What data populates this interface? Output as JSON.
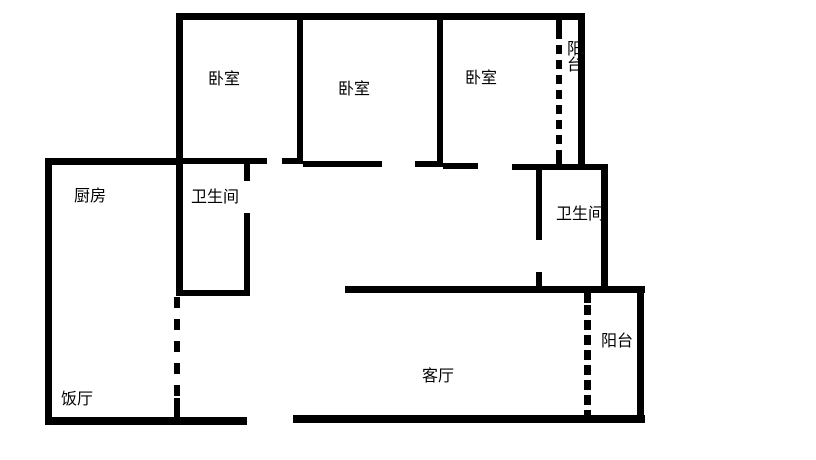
{
  "title": "apartment-floor-plan",
  "colors": {
    "wall": "#000000",
    "background": "#ffffff",
    "text": "#000000"
  },
  "rooms": [
    {
      "id": "bedroom-1",
      "label": "卧室",
      "x": 208,
      "y": 72,
      "vertical": false
    },
    {
      "id": "bedroom-2",
      "label": "卧室",
      "x": 338,
      "y": 82,
      "vertical": false
    },
    {
      "id": "bedroom-3",
      "label": "卧室",
      "x": 465,
      "y": 71,
      "vertical": false
    },
    {
      "id": "balcony-top",
      "label": "阳台",
      "x": 563,
      "y": 40,
      "vertical": true
    },
    {
      "id": "kitchen",
      "label": "厨房",
      "x": 74,
      "y": 189,
      "vertical": false
    },
    {
      "id": "bathroom-left",
      "label": "卫生间",
      "x": 191,
      "y": 190,
      "vertical": false
    },
    {
      "id": "bathroom-right",
      "label": "卫生间",
      "x": 556,
      "y": 207,
      "vertical": false
    },
    {
      "id": "living-room",
      "label": "客厅",
      "x": 422,
      "y": 369,
      "vertical": false
    },
    {
      "id": "balcony-right",
      "label": "阳台",
      "x": 601,
      "y": 334,
      "vertical": false
    },
    {
      "id": "dining-room",
      "label": "饭厅",
      "x": 61,
      "y": 392,
      "vertical": false
    }
  ],
  "walls": {
    "solid": [
      {
        "name": "top-outer-wall",
        "x": 177,
        "y": 13,
        "w": 408,
        "h": 7
      },
      {
        "name": "bedroom1-left-wall",
        "x": 176,
        "y": 13,
        "w": 7,
        "h": 283
      },
      {
        "name": "divider-bedroom1-bedroom2",
        "x": 297,
        "y": 13,
        "w": 6,
        "h": 151
      },
      {
        "name": "divider-bedroom2-bedroom3",
        "x": 437,
        "y": 13,
        "w": 6,
        "h": 153
      },
      {
        "name": "bedroom3-right-wall",
        "x": 578,
        "y": 13,
        "w": 7,
        "h": 154
      },
      {
        "name": "balcony-top-stub-upper",
        "x": 556,
        "y": 20,
        "w": 6,
        "h": 10
      },
      {
        "name": "balcony-top-stub-lower",
        "x": 556,
        "y": 152,
        "w": 6,
        "h": 15
      },
      {
        "name": "kitchen-top-wall",
        "x": 45,
        "y": 158,
        "w": 138,
        "h": 7
      },
      {
        "name": "left-outer-wall",
        "x": 45,
        "y": 158,
        "w": 7,
        "h": 267
      },
      {
        "name": "bathroomL-top-wall",
        "x": 183,
        "y": 158,
        "w": 84,
        "h": 6
      },
      {
        "name": "hall-wall-seg-282-303",
        "x": 282,
        "y": 158,
        "w": 21,
        "h": 6
      },
      {
        "name": "bedroom2-bottom-left",
        "x": 303,
        "y": 161,
        "w": 79,
        "h": 6
      },
      {
        "name": "bedroom2-bottom-right",
        "x": 415,
        "y": 161,
        "w": 28,
        "h": 6
      },
      {
        "name": "bedroom3-bottom-left",
        "x": 443,
        "y": 163,
        "w": 35,
        "h": 6
      },
      {
        "name": "bedroom3-bottom-right",
        "x": 512,
        "y": 164,
        "w": 95,
        "h": 6
      },
      {
        "name": "bathroomL-right-wall-upper",
        "x": 244,
        "y": 163,
        "w": 6,
        "h": 18
      },
      {
        "name": "bathroomL-right-wall-lower",
        "x": 244,
        "y": 213,
        "w": 6,
        "h": 83
      },
      {
        "name": "bathroomL-bottom-wall",
        "x": 177,
        "y": 290,
        "w": 73,
        "h": 6
      },
      {
        "name": "bathroomR-left-wall-upper",
        "x": 536,
        "y": 168,
        "w": 6,
        "h": 72
      },
      {
        "name": "bathroomR-left-wall-lower",
        "x": 536,
        "y": 272,
        "w": 6,
        "h": 20
      },
      {
        "name": "bathroomR-right-wall",
        "x": 601,
        "y": 164,
        "w": 7,
        "h": 126
      },
      {
        "name": "livingroom-top-wall",
        "x": 345,
        "y": 286,
        "w": 300,
        "h": 7
      },
      {
        "name": "balconyR-right-wall",
        "x": 637,
        "y": 286,
        "w": 7,
        "h": 137
      },
      {
        "name": "balconyR-dash-stub",
        "x": 584,
        "y": 293,
        "w": 7,
        "h": 10
      },
      {
        "name": "left-dash-bottom-connector",
        "x": 174,
        "y": 398,
        "w": 6,
        "h": 23
      },
      {
        "name": "dining-bottom-wall",
        "x": 45,
        "y": 417,
        "w": 202,
        "h": 8
      },
      {
        "name": "livingroom-bottom-wall",
        "x": 293,
        "y": 415,
        "w": 352,
        "h": 8
      }
    ],
    "dashed": [
      {
        "name": "balcony-top-dashed-partition",
        "x": 556,
        "y": 30,
        "w": 6,
        "h": 122,
        "dash": 9,
        "gap": 6
      },
      {
        "name": "dining-dashed-partition",
        "x": 174,
        "y": 297,
        "w": 6,
        "h": 101,
        "dash": 11,
        "gap": 11
      },
      {
        "name": "balconyR-dashed-partition",
        "x": 584,
        "y": 305,
        "w": 7,
        "h": 110,
        "dash": 10,
        "gap": 5
      }
    ]
  }
}
